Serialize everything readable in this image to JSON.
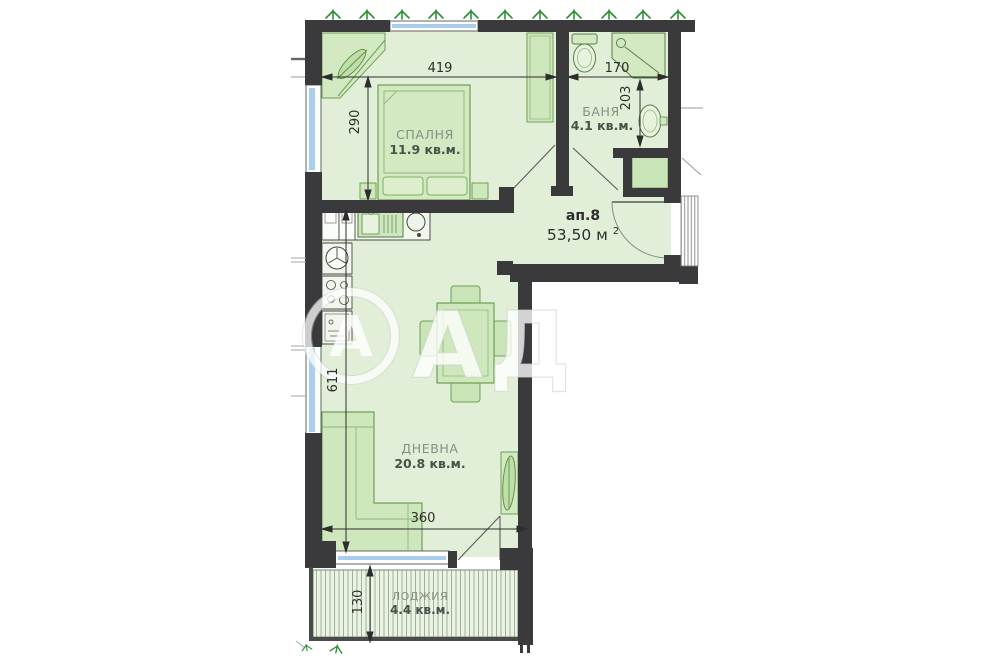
{
  "apartment": {
    "number": "ап.8",
    "area_value": "53,50 м",
    "area_sup": "2"
  },
  "rooms": {
    "bedroom": {
      "name": "СПАЛНЯ",
      "area": "11.9 кв.м."
    },
    "bathroom": {
      "name": "БАНЯ",
      "area": "4.1 кв.м."
    },
    "living_room": {
      "name": "ДНЕВНА",
      "area": "20.8 кв.м."
    },
    "loggia": {
      "name": "ЛОДЖИЯ",
      "area": "4.4 кв.м."
    }
  },
  "dimensions_cm": {
    "bedroom_width": "419",
    "bathroom_width": "170",
    "bedroom_depth": "290",
    "bathroom_depth": "203",
    "living_length": "611",
    "living_width": "360",
    "loggia_depth": "130"
  },
  "watermark": {
    "logo_letter": "А",
    "letters": "АД"
  },
  "colors": {
    "wall": "#3a3a3c",
    "room_fill": "#e2efd8",
    "loggia_fill": "#ebf4e3",
    "furniture_fill": "#cee7bc",
    "furniture_stroke": "#6fa054",
    "window_glass": "#a9cdec",
    "dimension_text": "#2d2d2d",
    "room_name_text": "#859084",
    "area_text": "#47524a",
    "grass": "#2f8f35"
  }
}
